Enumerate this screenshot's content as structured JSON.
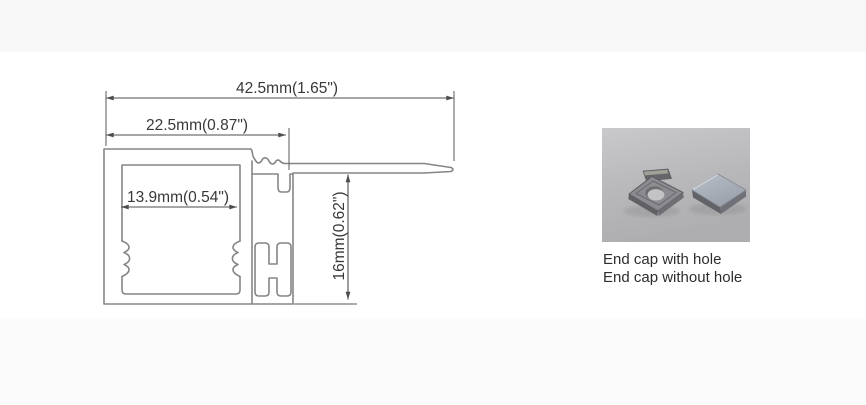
{
  "technical_drawing": {
    "dim_overall_width": "42.5mm(1.65\")",
    "dim_body_width": "22.5mm(0.87\")",
    "dim_inner_width": "13.9mm(0.54\")",
    "dim_height": "16mm(0.62\")"
  },
  "end_cap_photo": {
    "labels": [
      "End cap with hole",
      "End cap without hole"
    ]
  },
  "colors": {
    "page_background": "#fdfdfd",
    "profile_line": "#858585",
    "dimension_line": "#4c4c4c",
    "dimension_text": "#383838",
    "caption_text": "#2d2d2d",
    "photo_background": "#bcbcbe",
    "cap_with_hole_face": "#8b8b90",
    "cap_without_hole_face": "#aeb3bd"
  }
}
